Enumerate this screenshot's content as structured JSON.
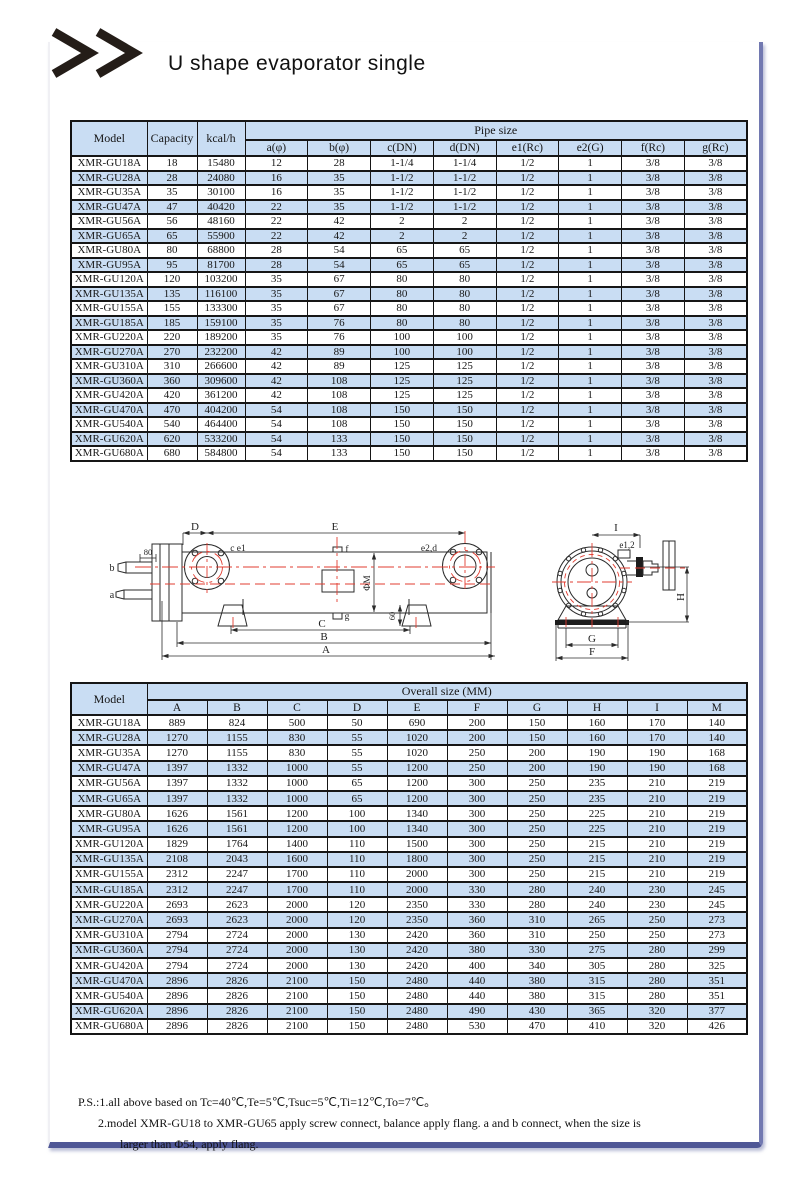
{
  "page": {
    "title": "U shape evaporator single",
    "logo_icon": "double-chevron-icon"
  },
  "colors": {
    "stripe_blue": "#c9ddf3",
    "frame_blue": "#4f5796",
    "diagram_red": "#e23d31",
    "line_black": "#2b2b2b"
  },
  "pipe_table": {
    "header": {
      "model": "Model",
      "capacity": "Capacity",
      "kcal": "kcal/h",
      "group": "Pipe size",
      "cols": [
        "a(φ)",
        "b(φ)",
        "c(DN)",
        "d(DN)",
        "e1(Rc)",
        "e2(G)",
        "f(Rc)",
        "g(Rc)"
      ]
    },
    "rows": [
      [
        "XMR-GU18A",
        "18",
        "15480",
        "12",
        "28",
        "1-1/4",
        "1-1/4",
        "1/2",
        "1",
        "3/8",
        "3/8"
      ],
      [
        "XMR-GU28A",
        "28",
        "24080",
        "16",
        "35",
        "1-1/2",
        "1-1/2",
        "1/2",
        "1",
        "3/8",
        "3/8"
      ],
      [
        "XMR-GU35A",
        "35",
        "30100",
        "16",
        "35",
        "1-1/2",
        "1-1/2",
        "1/2",
        "1",
        "3/8",
        "3/8"
      ],
      [
        "XMR-GU47A",
        "47",
        "40420",
        "22",
        "35",
        "1-1/2",
        "1-1/2",
        "1/2",
        "1",
        "3/8",
        "3/8"
      ],
      [
        "XMR-GU56A",
        "56",
        "48160",
        "22",
        "42",
        "2",
        "2",
        "1/2",
        "1",
        "3/8",
        "3/8"
      ],
      [
        "XMR-GU65A",
        "65",
        "55900",
        "22",
        "42",
        "2",
        "2",
        "1/2",
        "1",
        "3/8",
        "3/8"
      ],
      [
        "XMR-GU80A",
        "80",
        "68800",
        "28",
        "54",
        "65",
        "65",
        "1/2",
        "1",
        "3/8",
        "3/8"
      ],
      [
        "XMR-GU95A",
        "95",
        "81700",
        "28",
        "54",
        "65",
        "65",
        "1/2",
        "1",
        "3/8",
        "3/8"
      ],
      [
        "XMR-GU120A",
        "120",
        "103200",
        "35",
        "67",
        "80",
        "80",
        "1/2",
        "1",
        "3/8",
        "3/8"
      ],
      [
        "XMR-GU135A",
        "135",
        "116100",
        "35",
        "67",
        "80",
        "80",
        "1/2",
        "1",
        "3/8",
        "3/8"
      ],
      [
        "XMR-GU155A",
        "155",
        "133300",
        "35",
        "67",
        "80",
        "80",
        "1/2",
        "1",
        "3/8",
        "3/8"
      ],
      [
        "XMR-GU185A",
        "185",
        "159100",
        "35",
        "76",
        "80",
        "80",
        "1/2",
        "1",
        "3/8",
        "3/8"
      ],
      [
        "XMR-GU220A",
        "220",
        "189200",
        "35",
        "76",
        "100",
        "100",
        "1/2",
        "1",
        "3/8",
        "3/8"
      ],
      [
        "XMR-GU270A",
        "270",
        "232200",
        "42",
        "89",
        "100",
        "100",
        "1/2",
        "1",
        "3/8",
        "3/8"
      ],
      [
        "XMR-GU310A",
        "310",
        "266600",
        "42",
        "89",
        "125",
        "125",
        "1/2",
        "1",
        "3/8",
        "3/8"
      ],
      [
        "XMR-GU360A",
        "360",
        "309600",
        "42",
        "108",
        "125",
        "125",
        "1/2",
        "1",
        "3/8",
        "3/8"
      ],
      [
        "XMR-GU420A",
        "420",
        "361200",
        "42",
        "108",
        "125",
        "125",
        "1/2",
        "1",
        "3/8",
        "3/8"
      ],
      [
        "XMR-GU470A",
        "470",
        "404200",
        "54",
        "108",
        "150",
        "150",
        "1/2",
        "1",
        "3/8",
        "3/8"
      ],
      [
        "XMR-GU540A",
        "540",
        "464400",
        "54",
        "108",
        "150",
        "150",
        "1/2",
        "1",
        "3/8",
        "3/8"
      ],
      [
        "XMR-GU620A",
        "620",
        "533200",
        "54",
        "133",
        "150",
        "150",
        "1/2",
        "1",
        "3/8",
        "3/8"
      ],
      [
        "XMR-GU680A",
        "680",
        "584800",
        "54",
        "133",
        "150",
        "150",
        "1/2",
        "1",
        "3/8",
        "3/8"
      ]
    ]
  },
  "overall_table": {
    "header": {
      "model": "Model",
      "group": "Overall size (MM)",
      "cols": [
        "A",
        "B",
        "C",
        "D",
        "E",
        "F",
        "G",
        "H",
        "I",
        "M"
      ]
    },
    "rows": [
      [
        "XMR-GU18A",
        "889",
        "824",
        "500",
        "50",
        "690",
        "200",
        "150",
        "160",
        "170",
        "140"
      ],
      [
        "XMR-GU28A",
        "1270",
        "1155",
        "830",
        "55",
        "1020",
        "200",
        "150",
        "160",
        "170",
        "140"
      ],
      [
        "XMR-GU35A",
        "1270",
        "1155",
        "830",
        "55",
        "1020",
        "250",
        "200",
        "190",
        "190",
        "168"
      ],
      [
        "XMR-GU47A",
        "1397",
        "1332",
        "1000",
        "55",
        "1200",
        "250",
        "200",
        "190",
        "190",
        "168"
      ],
      [
        "XMR-GU56A",
        "1397",
        "1332",
        "1000",
        "65",
        "1200",
        "300",
        "250",
        "235",
        "210",
        "219"
      ],
      [
        "XMR-GU65A",
        "1397",
        "1332",
        "1000",
        "65",
        "1200",
        "300",
        "250",
        "235",
        "210",
        "219"
      ],
      [
        "XMR-GU80A",
        "1626",
        "1561",
        "1200",
        "100",
        "1340",
        "300",
        "250",
        "225",
        "210",
        "219"
      ],
      [
        "XMR-GU95A",
        "1626",
        "1561",
        "1200",
        "100",
        "1340",
        "300",
        "250",
        "225",
        "210",
        "219"
      ],
      [
        "XMR-GU120A",
        "1829",
        "1764",
        "1400",
        "110",
        "1500",
        "300",
        "250",
        "215",
        "210",
        "219"
      ],
      [
        "XMR-GU135A",
        "2108",
        "2043",
        "1600",
        "110",
        "1800",
        "300",
        "250",
        "215",
        "210",
        "219"
      ],
      [
        "XMR-GU155A",
        "2312",
        "2247",
        "1700",
        "110",
        "2000",
        "300",
        "250",
        "215",
        "210",
        "219"
      ],
      [
        "XMR-GU185A",
        "2312",
        "2247",
        "1700",
        "110",
        "2000",
        "330",
        "280",
        "240",
        "230",
        "245"
      ],
      [
        "XMR-GU220A",
        "2693",
        "2623",
        "2000",
        "120",
        "2350",
        "330",
        "280",
        "240",
        "230",
        "245"
      ],
      [
        "XMR-GU270A",
        "2693",
        "2623",
        "2000",
        "120",
        "2350",
        "360",
        "310",
        "265",
        "250",
        "273"
      ],
      [
        "XMR-GU310A",
        "2794",
        "2724",
        "2000",
        "130",
        "2420",
        "360",
        "310",
        "250",
        "250",
        "273"
      ],
      [
        "XMR-GU360A",
        "2794",
        "2724",
        "2000",
        "130",
        "2420",
        "380",
        "330",
        "275",
        "280",
        "299"
      ],
      [
        "XMR-GU420A",
        "2794",
        "2724",
        "2000",
        "130",
        "2420",
        "400",
        "340",
        "305",
        "280",
        "325"
      ],
      [
        "XMR-GU470A",
        "2896",
        "2826",
        "2100",
        "150",
        "2480",
        "440",
        "380",
        "315",
        "280",
        "351"
      ],
      [
        "XMR-GU540A",
        "2896",
        "2826",
        "2100",
        "150",
        "2480",
        "440",
        "380",
        "315",
        "280",
        "351"
      ],
      [
        "XMR-GU620A",
        "2896",
        "2826",
        "2100",
        "150",
        "2480",
        "490",
        "430",
        "365",
        "320",
        "377"
      ],
      [
        "XMR-GU680A",
        "2896",
        "2826",
        "2100",
        "150",
        "2480",
        "530",
        "470",
        "410",
        "320",
        "426"
      ]
    ]
  },
  "diagram": {
    "labels": {
      "dim_80": "80",
      "port_b": "b",
      "port_a": "a",
      "dim_D": "D",
      "dim_E": "E",
      "label_ce1": "c e1",
      "label_f": "f",
      "label_e2d": "e2,d",
      "label_phiM": "ΦM",
      "label_g": "g",
      "dim_60": "60",
      "dim_C": "C",
      "dim_B": "B",
      "dim_A": "A",
      "dim_I": "I",
      "label_e12": "e1,2",
      "dim_H": "H",
      "dim_G": "G",
      "dim_F": "F"
    }
  },
  "notes": {
    "line1": "P.S.:1.all above based on Tc=40℃,Te=5℃,Tsuc=5℃,Ti=12℃,To=7℃。",
    "line2": "2.model XMR-GU18 to XMR-GU65 apply screw connect, balance apply flang. a and b connect, when the size is",
    "line3": "larger than Φ54, apply flang."
  }
}
